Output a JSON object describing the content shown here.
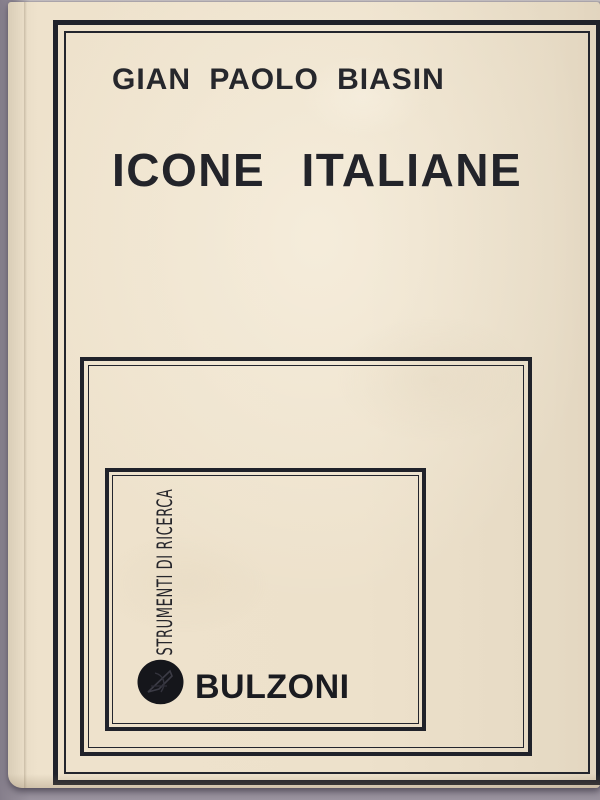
{
  "book_cover": {
    "author": "GIAN PAOLO BIASIN",
    "title": "ICONE ITALIANE",
    "series_label": "STRUMENTI DI RICERCA",
    "publisher": "BULZONI",
    "colors": {
      "ink": "#20222a",
      "cover_paper": "#ebdfc9",
      "backdrop_gray": "#8e8793"
    },
    "icons": {
      "publisher_logo": "bulzoni-black-oval-monogram"
    }
  }
}
